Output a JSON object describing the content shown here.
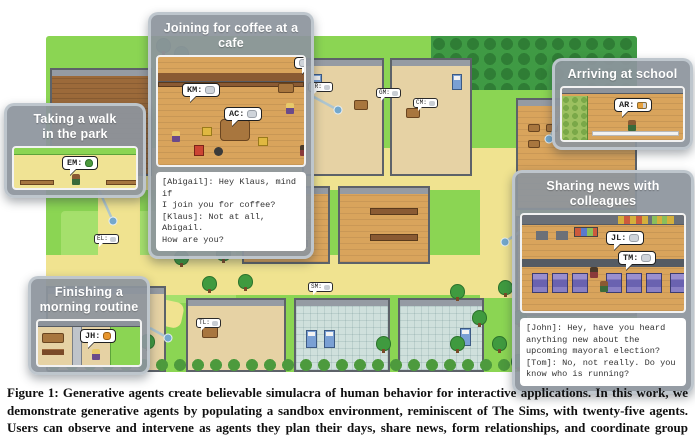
{
  "figure": {
    "caption": "Figure 1: Generative agents create believable simulacra of human behavior for interactive applications. In this work, we demonstrate generative agents by populating a sandbox environment, reminiscent of The Sims, with twenty-five agents. Users can observe and intervene as agents they plan their days, share news, form relationships, and coordinate group activities."
  },
  "colors": {
    "grass": "#8bd553",
    "path": "#f0e390",
    "callout_header": "#8d959d",
    "leader_line": "#a9c4d4",
    "leader_dot": "#74a8cc"
  },
  "callouts": {
    "cafe": {
      "title": "Joining for coffee at a cafe",
      "bubbles": [
        {
          "label": "KM:",
          "icon": "chat-icon"
        },
        {
          "label": "AC:",
          "icon": "chat-icon"
        }
      ],
      "dialogue": "[Abigail]: Hey Klaus, mind if\nI join you for coffee?\n[Klaus]: Not at all, Abigail.\nHow are you?"
    },
    "walk": {
      "title": "Taking a walk\nin the park",
      "bubbles": [
        {
          "label": "EM:",
          "icon": "tree-icon"
        }
      ]
    },
    "school": {
      "title": "Arriving at school",
      "bubbles": [
        {
          "label": "AR:",
          "icon": "pencil-icon"
        }
      ]
    },
    "news": {
      "title": "Sharing news with colleagues",
      "bubbles": [
        {
          "label": "JL:",
          "icon": "chat-icon"
        },
        {
          "label": "TM:",
          "icon": "chat-icon"
        }
      ],
      "dialogue": "[John]: Hey, have you heard\nanything new about the\nupcoming mayoral election?\n[Tom]: No, not really. Do you\nknow who is running?"
    },
    "routine": {
      "title": "Finishing a\nmorning routine",
      "bubbles": [
        {
          "label": "JH:",
          "icon": "soap-icon"
        }
      ]
    }
  },
  "map": {
    "bubbles": [
      {
        "label": "IR:"
      },
      {
        "label": "GM:"
      },
      {
        "label": "CM:"
      },
      {
        "label": "MB:"
      },
      {
        "label": "EL:"
      },
      {
        "label": "TL:"
      },
      {
        "label": "SM:"
      }
    ]
  }
}
